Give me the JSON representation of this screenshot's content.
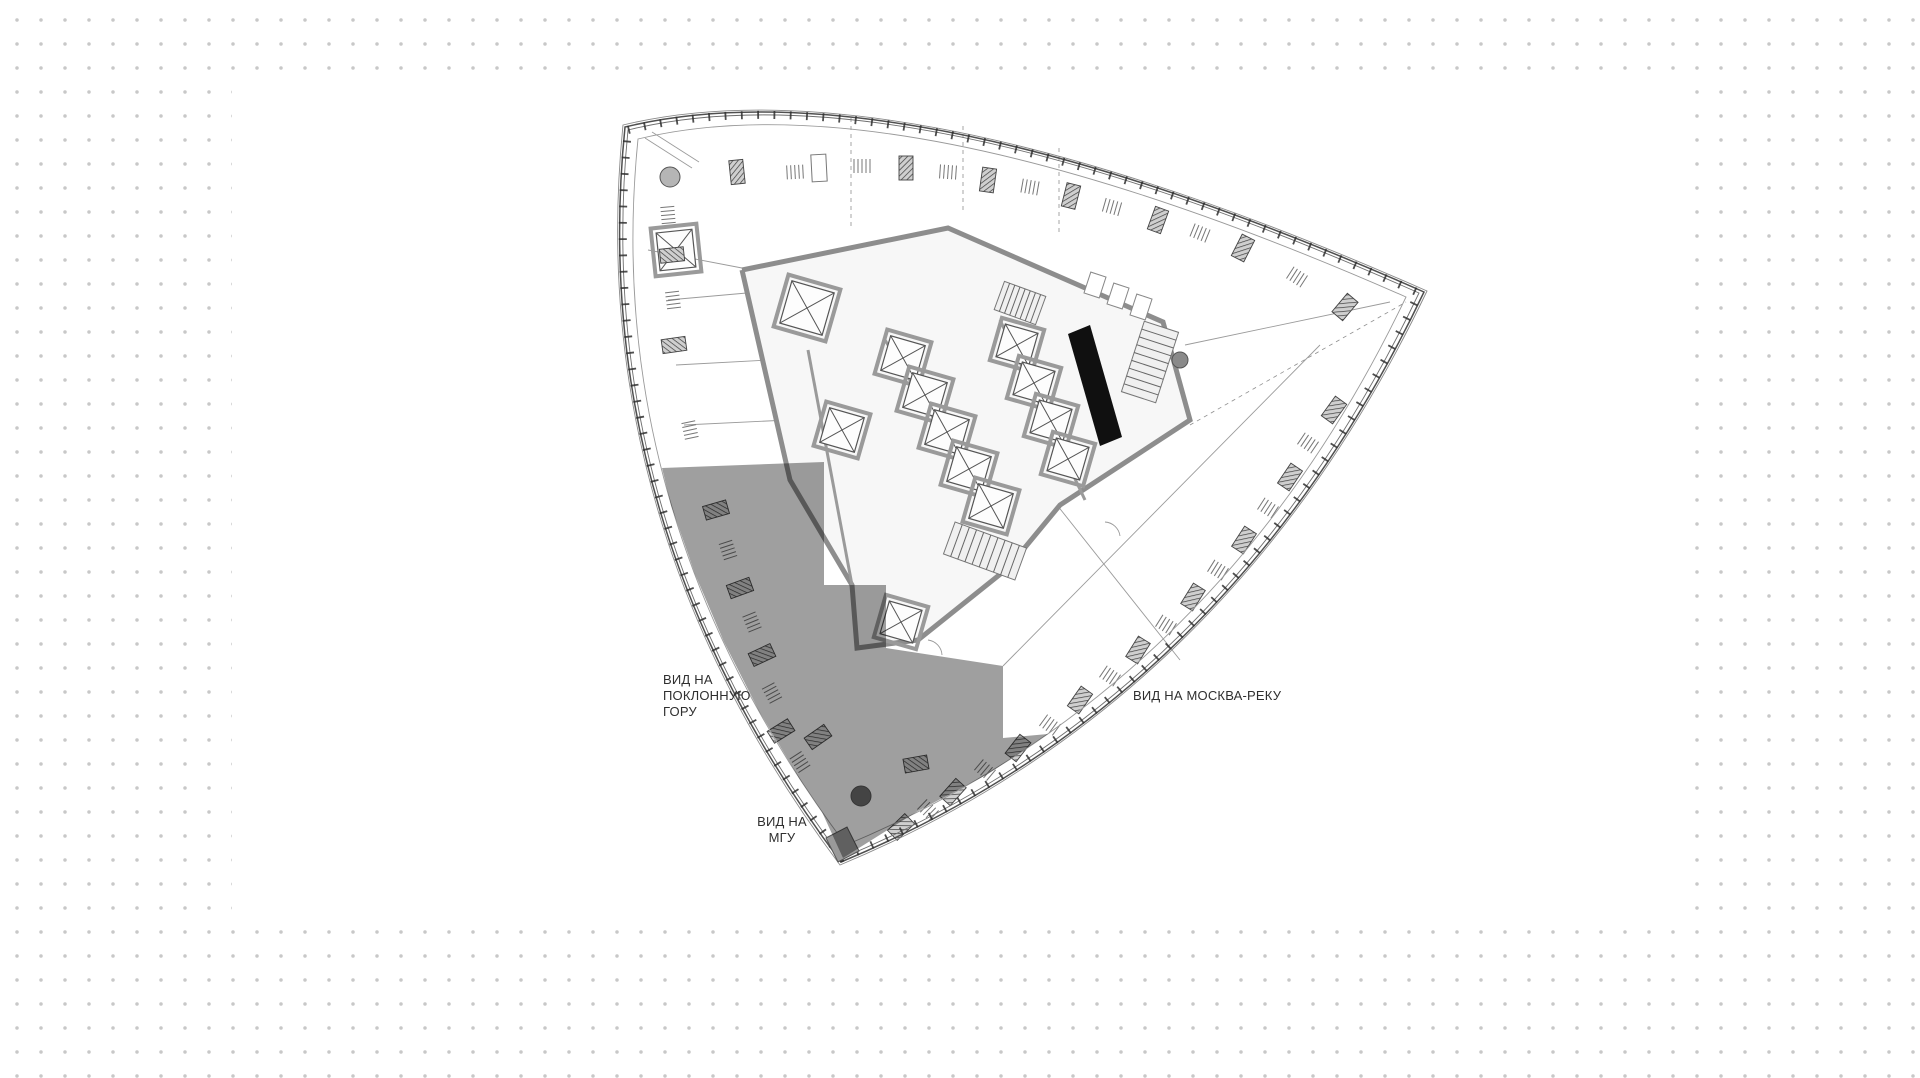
{
  "background": {
    "dot_color": "#c8c8c8",
    "sheet_color": "#ffffff"
  },
  "labels": {
    "view_poklonnaya": [
      "ВИД НА",
      "ПОКЛОННУЮ",
      "ГОРУ"
    ],
    "view_msu": [
      "ВИД НА",
      "МГУ"
    ],
    "view_moskva": "ВИД НА МОСКВА-РЕКУ"
  },
  "highlight": {
    "color": "#9f9f9f"
  }
}
